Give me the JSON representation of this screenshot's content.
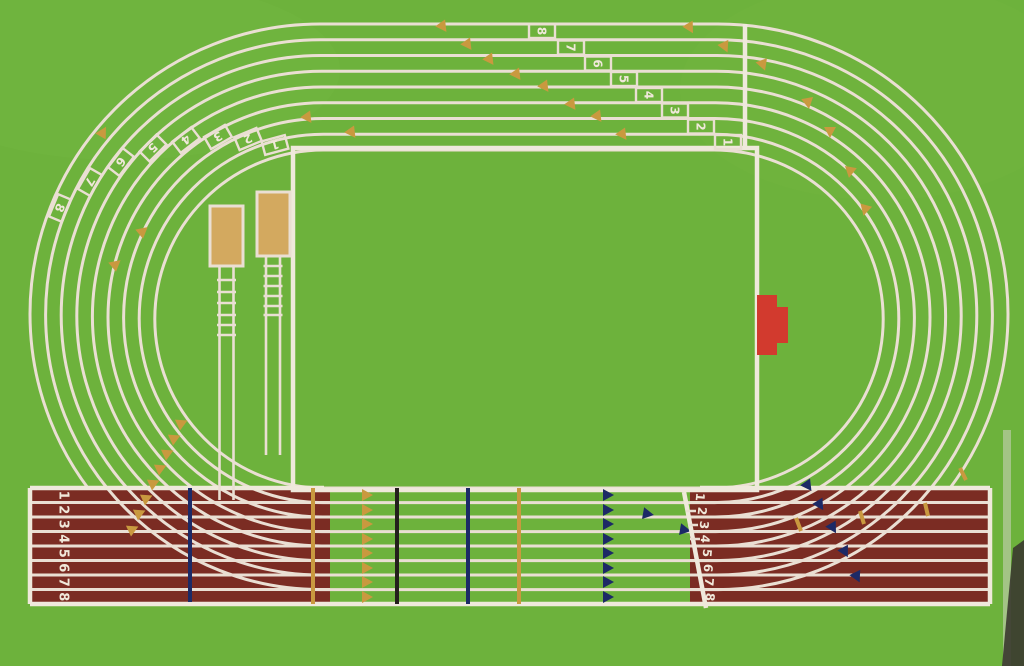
{
  "artwork": {
    "title": "painting-of-athletics-running-track-top-view",
    "lanes": 8
  },
  "colors": {
    "grass_green": "#6db23c",
    "infield_green": "#6fb23c",
    "track_maroon": "#7b2c23",
    "lane_line": "#eadfd3",
    "gold_marker": "#c9993f",
    "sand_pit": "#d3a95f",
    "red_mat": "#d23a2e",
    "navy_marker": "#1c2a66",
    "black_marker": "#241f1c",
    "canvas_edge_dark": "#3a382f"
  },
  "lane_numbers": {
    "top_stagger": [
      "8",
      "7",
      "6",
      "5",
      "4",
      "3",
      "2",
      "1"
    ],
    "left_curve_stagger": [
      "1",
      "2",
      "3",
      "4",
      "5",
      "6",
      "7",
      "8"
    ],
    "start_chute": [
      "1",
      "2",
      "3",
      "4",
      "5",
      "6",
      "7",
      "8"
    ],
    "finish_line": [
      "1",
      "2",
      "3",
      "4",
      "5",
      "6",
      "7",
      "8"
    ]
  },
  "features": {
    "long_jump_pits": "2 sand pits with runways in left infield zone",
    "red_mat": "red equipment mat in right infield zone",
    "gold_triangles": "relay exchange-zone wedge markers",
    "navy_triangles": "hurdle / zone wedge markers",
    "start_line_top": "vertical start line across top straight",
    "finish_line": "diagonal finish line with lane numbers 1-8"
  }
}
